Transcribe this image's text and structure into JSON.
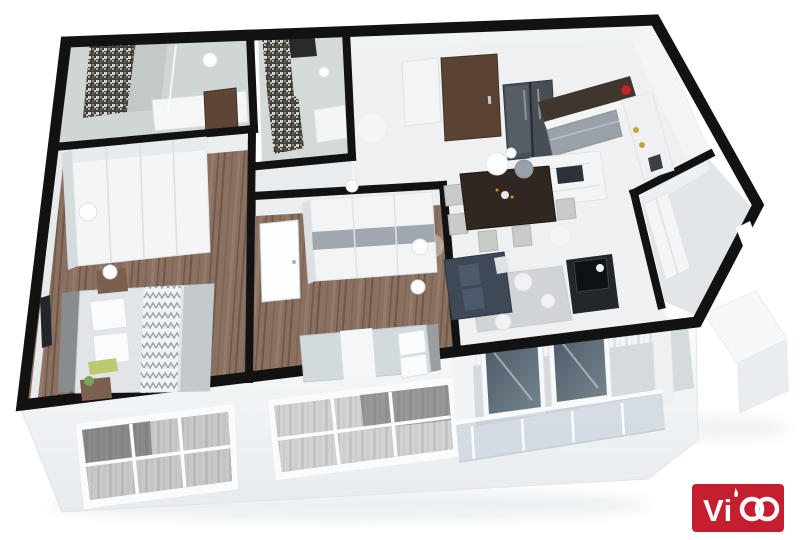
{
  "scene": {
    "type": "3d-floor-plan-render",
    "description": "Isometric 3D render of a two-bedroom apartment: two mosaic-tiled bathrooms at top left, master bedroom and second bedroom with wood floors along the bottom, open kitchen with L-shaped counter and double-door fridge at top right, dining table with chairs and pendant lamps, living room with dark sofa and TV console, small utility room on the right, balcony with glass railing at bottom right, and a white street facade with paned windows showing curtains",
    "background": "#ffffff"
  },
  "palette": {
    "wall": "#121212",
    "wood_floor": "#8a7060",
    "marble_floor": "#eef0f2",
    "bath_tile": "#cfd6d3",
    "facade": "#f4f6f7",
    "window_glass": "#4b5a66",
    "sofa": "#3e4857",
    "entry_door": "#5a4334",
    "accent_red": "#c0272d",
    "railing_glass": "#b9c7d2"
  },
  "rooms": [
    {
      "id": "bathroom-1",
      "furniture": [
        "mosaic-wall",
        "vanity-tub",
        "shower-glass",
        "wood-door"
      ]
    },
    {
      "id": "bathroom-2",
      "furniture": [
        "mosaic-wall",
        "shower-niche",
        "vanity"
      ]
    },
    {
      "id": "master-bedroom",
      "furniture": [
        "wardrobe",
        "double-bed",
        "nightstands",
        "wall-tv",
        "sphere-lamp"
      ]
    },
    {
      "id": "bedroom-2",
      "furniture": [
        "wardrobe",
        "double-bed",
        "white-door",
        "sphere-lamps"
      ]
    },
    {
      "id": "hallway",
      "furniture": []
    },
    {
      "id": "kitchen",
      "furniture": [
        "entry-door",
        "shoe-cabinet",
        "fridge",
        "l-counter",
        "red-kettle",
        "island"
      ]
    },
    {
      "id": "dining-area",
      "furniture": [
        "dining-table",
        "chairs",
        "pendant-lamps"
      ]
    },
    {
      "id": "living-room",
      "furniture": [
        "sofa",
        "rug",
        "poufs",
        "tv-console"
      ]
    },
    {
      "id": "utility-room",
      "furniture": [
        "closet"
      ]
    },
    {
      "id": "balcony",
      "furniture": [
        "sliding-glass-doors",
        "curtains",
        "glass-railing"
      ]
    },
    {
      "id": "ac-ledge",
      "furniture": []
    }
  ],
  "logo": {
    "name": "Vico",
    "prefix": "Vi",
    "bg_color": "#c51f2f",
    "fg_color": "#ffffff"
  }
}
